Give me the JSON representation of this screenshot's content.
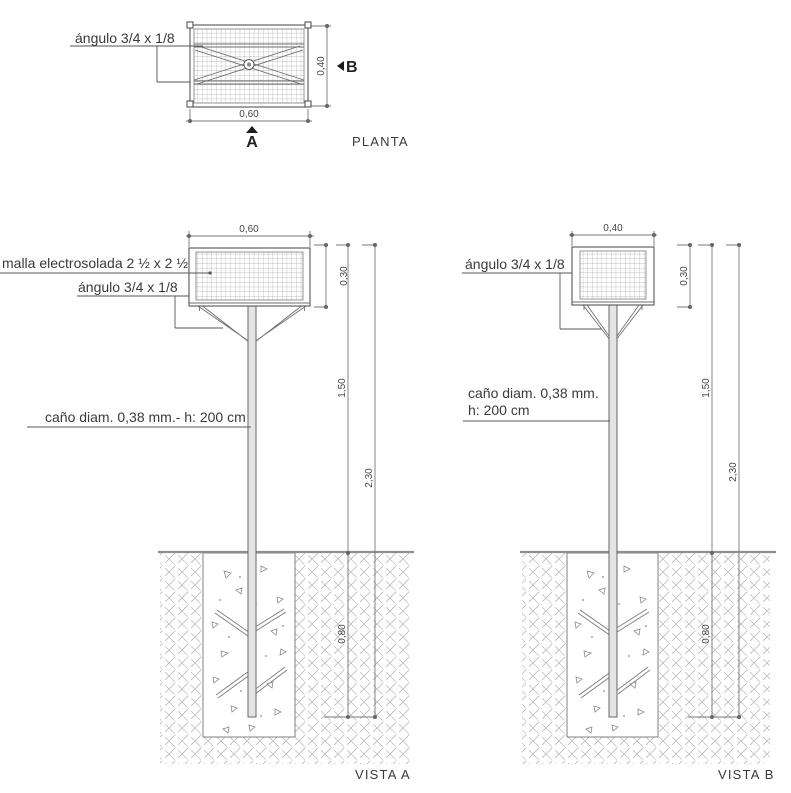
{
  "plan": {
    "title": "PLANTA",
    "label_angulo": "ángulo 3/4 x 1/8",
    "dim_width": "0,60",
    "dim_depth": "0,40",
    "marker_a": "A",
    "marker_b": "B"
  },
  "vista_a": {
    "title": "VISTA A",
    "label_malla": "malla electrosolada 2 ½ x 2 ½",
    "label_angulo": "ángulo 3/4 x 1/8",
    "label_cano": "caño diam. 0,38 mm.- h: 200 cm",
    "dim_width": "0,60",
    "dim_basket": "0,30",
    "dim_clear": "1,50",
    "dim_total": "2,30",
    "dim_depth": "0,80"
  },
  "vista_b": {
    "title": "VISTA B",
    "label_angulo": "ángulo 3/4 x 1/8",
    "label_cano_1": "caño diam. 0,38 mm.",
    "label_cano_2": "h: 200 cm",
    "dim_width": "0,40",
    "dim_basket": "0,30",
    "dim_clear": "1,50",
    "dim_total": "2,30",
    "dim_depth": "0,80"
  }
}
